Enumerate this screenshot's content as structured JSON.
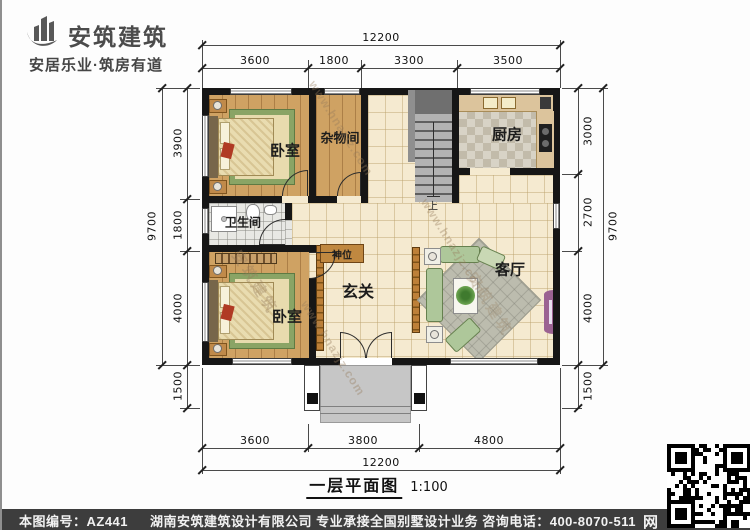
{
  "logo": {
    "company": "安筑建筑",
    "tagline": "安居乐业·筑房有道"
  },
  "rooms": {
    "bedroom1": "卧室",
    "storage": "杂物间",
    "kitchen": "厨房",
    "bathroom": "卫生间",
    "shrine": "神位",
    "foyer": "玄关",
    "living": "客厅",
    "bedroom2": "卧室",
    "stairs_up": "上"
  },
  "dims": {
    "top": {
      "total": "12200",
      "segments": [
        "3600",
        "1800",
        "3300",
        "3500"
      ]
    },
    "bottom": {
      "total": "12200",
      "segments": [
        "3600",
        "3800",
        "4800"
      ]
    },
    "left": {
      "outer": "9700",
      "segments": [
        "3900",
        "1800",
        "4000",
        "1500"
      ]
    },
    "right": {
      "outer": "9700",
      "segments": [
        "3000",
        "2700",
        "4000",
        "1500"
      ]
    }
  },
  "title": {
    "name": "一层平面图",
    "scale": "1:100"
  },
  "footer": {
    "plan_no": "本图编号：AZ441",
    "company_info": "湖南安筑建筑设计有限公司  专业承接全国别墅设计业务  咨询电话：400-8070-511",
    "web_char": "网"
  },
  "watermark": {
    "brand": "安筑建筑",
    "site": "www.hnazjz.com"
  },
  "colors": {
    "wall": "#161616",
    "wood_floor": "#cfa263",
    "tile_cream": "#f5ead0",
    "kitchen_tile": "#d8d3c6",
    "stair_gray": "#9e9e9e",
    "porch_gray": "#c6c6c6",
    "screen_wood": "#bd8038",
    "sofa_green": "#aec79a",
    "tv_purple": "#9b6292",
    "footer_bg": "#3d3d3d"
  }
}
